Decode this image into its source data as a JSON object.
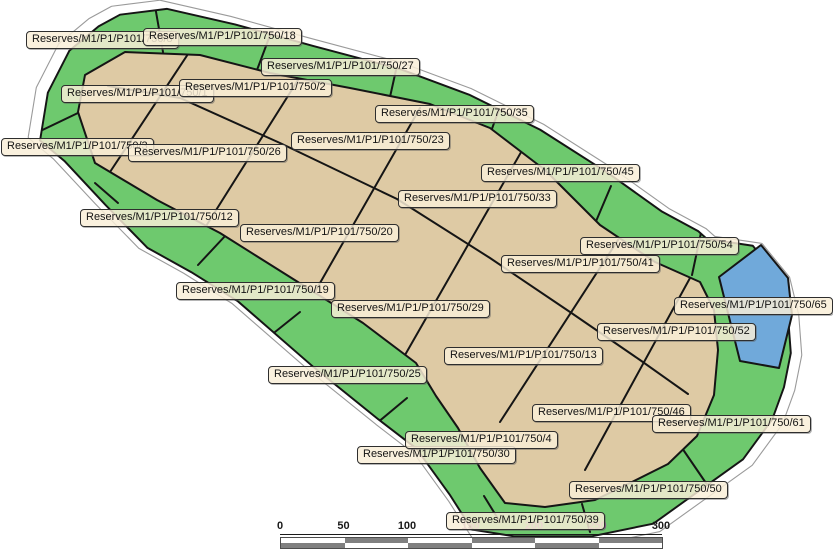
{
  "map": {
    "colors": {
      "reserve_green": "#6EC96E",
      "parcel_tan": "#DECAA4",
      "parcel_blue": "#70A9DA",
      "label_bg": "#F8EDD6",
      "boundary_gray": "#9A9A9A",
      "outline_black": "#151515"
    },
    "labels": [
      {
        "text": "Reserves/M1/P1/P101/750/8",
        "x": 26,
        "y": 31
      },
      {
        "text": "Reserves/M1/P1/P101/750/18",
        "x": 143,
        "y": 28
      },
      {
        "text": "Reserves/M1/P1/P101/750/27",
        "x": 261,
        "y": 58
      },
      {
        "text": "Reserves/M1/P1/P101/750/1",
        "x": 61,
        "y": 85
      },
      {
        "text": "Reserves/M1/P1/P101/750/2",
        "x": 179,
        "y": 79
      },
      {
        "text": "Reserves/M1/P1/P101/750/35",
        "x": 375,
        "y": 105
      },
      {
        "text": "Reserves/M1/P1/P101/750/3",
        "x": 1,
        "y": 138
      },
      {
        "text": "Reserves/M1/P1/P101/750/26",
        "x": 128,
        "y": 144
      },
      {
        "text": "Reserves/M1/P1/P101/750/23",
        "x": 291,
        "y": 132
      },
      {
        "text": "Reserves/M1/P1/P101/750/12",
        "x": 80,
        "y": 209
      },
      {
        "text": "Reserves/M1/P1/P101/750/20",
        "x": 240,
        "y": 224
      },
      {
        "text": "Reserves/M1/P1/P101/750/45",
        "x": 481,
        "y": 164
      },
      {
        "text": "Reserves/M1/P1/P101/750/33",
        "x": 398,
        "y": 190
      },
      {
        "text": "Reserves/M1/P1/P101/750/54",
        "x": 580,
        "y": 237
      },
      {
        "text": "Reserves/M1/P1/P101/750/41",
        "x": 501,
        "y": 255
      },
      {
        "text": "Reserves/M1/P1/P101/750/19",
        "x": 176,
        "y": 282
      },
      {
        "text": "Reserves/M1/P1/P101/750/29",
        "x": 331,
        "y": 300
      },
      {
        "text": "Reserves/M1/P1/P101/750/65",
        "x": 674,
        "y": 297
      },
      {
        "text": "Reserves/M1/P1/P101/750/52",
        "x": 597,
        "y": 323
      },
      {
        "text": "Reserves/M1/P1/P101/750/13",
        "x": 444,
        "y": 347
      },
      {
        "text": "Reserves/M1/P1/P101/750/25",
        "x": 268,
        "y": 366
      },
      {
        "text": "Reserves/M1/P1/P101/750/46",
        "x": 532,
        "y": 404
      },
      {
        "text": "Reserves/M1/P1/P101/750/61",
        "x": 652,
        "y": 415
      },
      {
        "text": "Reserves/M1/P1/P101/750/30",
        "x": 357,
        "y": 446
      },
      {
        "text": "Reserves/M1/P1/P101/750/4",
        "x": 405,
        "y": 431
      },
      {
        "text": "Reserves/M1/P1/P101/750/50",
        "x": 569,
        "y": 481
      },
      {
        "text": "Reserves/M1/P1/P101/750/39",
        "x": 446,
        "y": 512
      }
    ]
  },
  "scale_bar": {
    "ticks": [
      {
        "label": "0",
        "color": "#1a1a1a"
      },
      {
        "label": "50",
        "color": "#1a1a1a"
      },
      {
        "label": "100",
        "color": "#1a1a1a"
      },
      {
        "label": "150",
        "color": "#a263a2"
      },
      {
        "label": "200",
        "color": "#a263a2"
      },
      {
        "label": "250",
        "color": "#a263a2"
      },
      {
        "label": "300",
        "color": "#1a1a1a"
      }
    ],
    "colors": {
      "dark": "#808080",
      "light": "#ffffff"
    }
  }
}
